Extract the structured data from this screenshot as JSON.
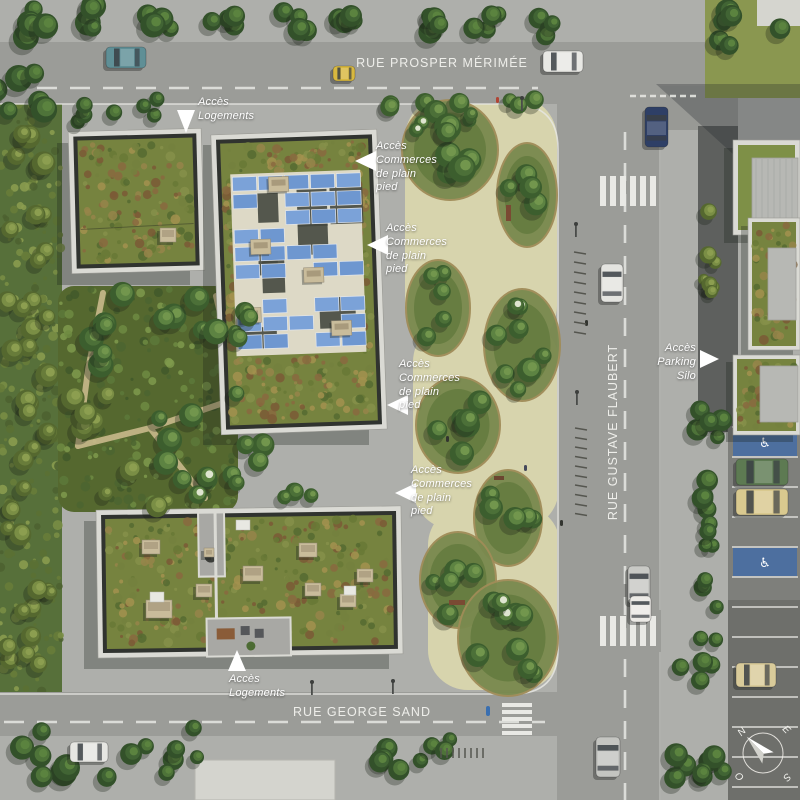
{
  "streets": {
    "top": "RUE PROSPER MÉRIMÉE",
    "right": "RUE GUSTAVE FLAUBERT",
    "bottom": "RUE GEORGE SAND"
  },
  "annotations": {
    "logements_top": "Accès\nLogements",
    "commerces_1": "Accès\nCommerces\nde plain\npied",
    "commerces_2": "Accès\nCommerces\nde plain\npied",
    "commerces_3": "Accès\nCommerces\nde plain\npied",
    "commerces_4": "Accès\nCommerces\nde plain\npied",
    "parking_silo": "Accès\nParking Silo",
    "logements_bottom": "Accès\nLogements"
  },
  "compass": {
    "north": "N",
    "east": "E",
    "south": "S",
    "west": "O"
  },
  "icons": {
    "wheelchair": "♿"
  },
  "colors": {
    "plaza": "#aeafab",
    "road": "#9b9c98",
    "park_path": "#d7d4ad",
    "sedum_roof": "#76833f",
    "solar_panel": "#7ba2d8",
    "handicap_blue": "#4d6f9f",
    "asphalt_dark": "#5e605e",
    "label_text": "#ffffff"
  }
}
